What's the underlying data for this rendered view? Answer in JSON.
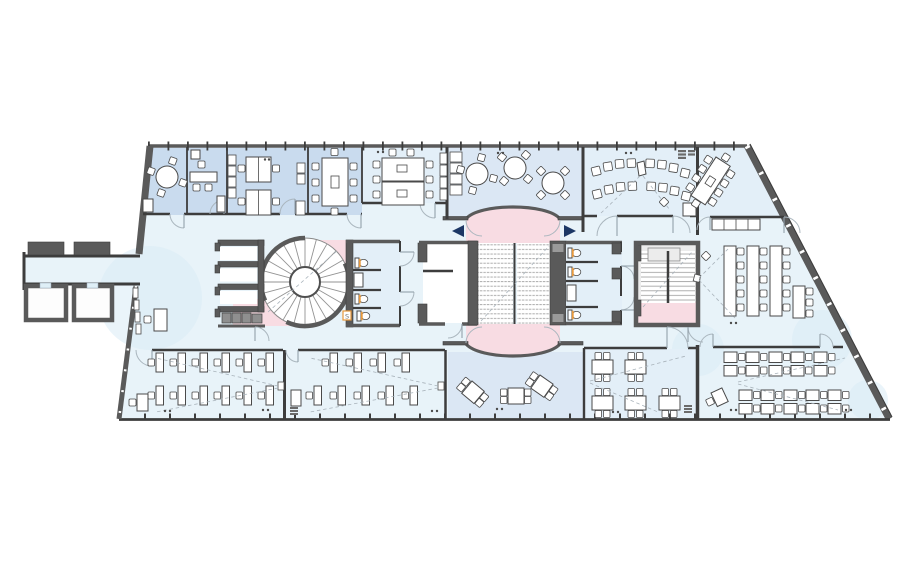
{
  "page": {
    "description": "Architectural floor plan of an office / teaching storey; trapezoidal footprint with angled glazed south-east facade, western entrance bridge, central double-flight stair with arched pink landings, spiral stair core, secondary stair and WC cores. No text labels visible except a tiny 'S' fixture tag in the west WC."
  },
  "palette": {
    "floor": "#e8f3f9",
    "room_blue": "#c9dbee",
    "room_blue_light": "#dbe7f4",
    "room_pale": "#e3eff8",
    "pink": "#f8dce3",
    "wall_dark": "#5a5a5a",
    "wall_mid": "#7a7a7a",
    "line_dark": "#3d3d3d",
    "stair_fill": "#efefef",
    "stair_gray": "#ececec",
    "tread_line": "#a5a5a5",
    "furniture_stroke": "#4a4a4a",
    "furniture_fill": "#ffffff",
    "accent_orange": "#e8993c",
    "arrow_navy": "#1c3765",
    "door_arc": "#aab6be",
    "shade": "#d9ebf5"
  },
  "fixtures": {
    "urinal_label": "S"
  },
  "icons": [
    {
      "name": "direction-arrow-left",
      "meaning": "circulation direction",
      "color": "#1c3765"
    },
    {
      "name": "direction-arrow-right",
      "meaning": "circulation direction",
      "color": "#1c3765"
    },
    {
      "name": "wc-icon",
      "meaning": "toilet fixture, orange seat mark",
      "color": "#e8993c"
    }
  ],
  "rooms": [
    {
      "id": "office-round-table",
      "fill": "room_blue",
      "furniture": "round table, 4 chairs"
    },
    {
      "id": "office-single",
      "fill": "room_blue",
      "furniture": "desk, 3 chairs, cabinets"
    },
    {
      "id": "office-double",
      "fill": "room_blue",
      "furniture": "2 double workstations, wardrobe strips"
    },
    {
      "id": "meeting-room-8",
      "fill": "room_blue",
      "furniture": "conference table, 8 chairs"
    },
    {
      "id": "conference-room-10",
      "fill": "room_pale",
      "furniture": "double conference table, 10 chairs, cabinets"
    },
    {
      "id": "cafe-lounge",
      "fill": "room_blue_light",
      "furniture": "3 round tables, 4 chairs each, sideboard"
    },
    {
      "id": "lecture-room",
      "fill": "room_pale",
      "furniture": "16 chairs in two curved rows, lectern, corner closet"
    },
    {
      "id": "meeting-room-east",
      "fill": "room_pale",
      "furniture": "angled conference table, 10 chairs, counter"
    },
    {
      "id": "reading-area-east",
      "fill": "floor",
      "furniture": "3 long study tables + 1 short, side chairs"
    },
    {
      "id": "classroom-southwest-1",
      "fill": "floor",
      "furniture": "12 single desks, teacher desk"
    },
    {
      "id": "classroom-southwest-2",
      "fill": "floor",
      "furniture": "9 single desks, teacher desk"
    },
    {
      "id": "break-area-south",
      "fill": "room_blue_light",
      "furniture": "3 square tables, 4 chairs each"
    },
    {
      "id": "group-room-south",
      "fill": "room_pale",
      "furniture": "5 four-seat group tables"
    },
    {
      "id": "classroom-southeast",
      "fill": "floor",
      "furniture": "10 double desks, teacher desk"
    },
    {
      "id": "elevator-lobby",
      "fill": "white",
      "furniture": ""
    },
    {
      "id": "wc-core-central",
      "fill": "room_pale",
      "furniture": "3 WC, sink"
    },
    {
      "id": "wc-core-west",
      "fill": "room_pale",
      "furniture": "2 WC, sink, urinal S"
    },
    {
      "id": "stair-main",
      "type": "double flight stair, pink arched landings"
    },
    {
      "id": "stair-spiral",
      "type": "spiral stair with locker niches"
    },
    {
      "id": "stair-secondary",
      "type": "U-return stair, pink landing"
    },
    {
      "id": "west-bridge",
      "furniture": "entrance corridor, two store rooms, reception desk"
    }
  ]
}
